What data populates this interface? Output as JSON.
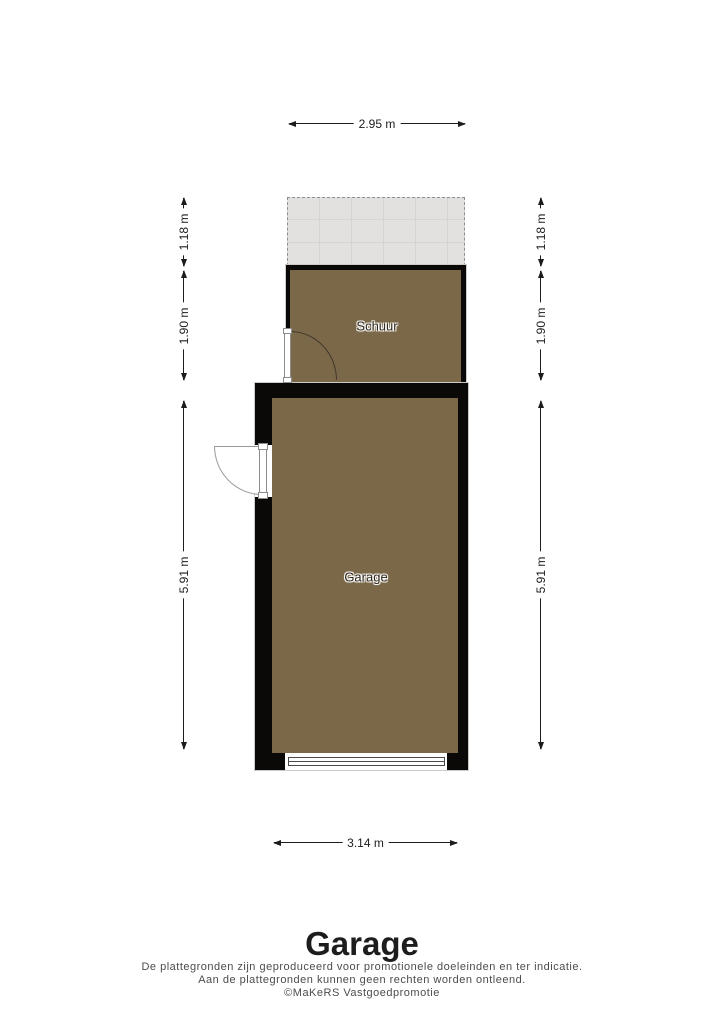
{
  "plan": {
    "rooms": {
      "schuur": {
        "label": "Schuur"
      },
      "garage": {
        "label": "Garage"
      }
    },
    "dims": {
      "top": "2.95 m",
      "bottom": "3.14 m",
      "left_upper": "1.18 m",
      "left_mid": "1.90 m",
      "left_lower": "5.91 m",
      "right_upper": "1.18 m",
      "right_mid": "1.90 m",
      "right_lower": "5.91 m"
    },
    "colors": {
      "floor": "#7b6849",
      "wall": "#0b0907",
      "tile_area": "#e3e1df",
      "tile_grid": "#d6d3d0"
    }
  },
  "footer": {
    "title": "Garage",
    "disclaimer": [
      "De plattegronden zijn geproduceerd voor promotionele doeleinden en ter indicatie.",
      "Aan de plattegronden kunnen geen rechten worden ontleend.",
      "©MaKeRS Vastgoedpromotie"
    ]
  }
}
